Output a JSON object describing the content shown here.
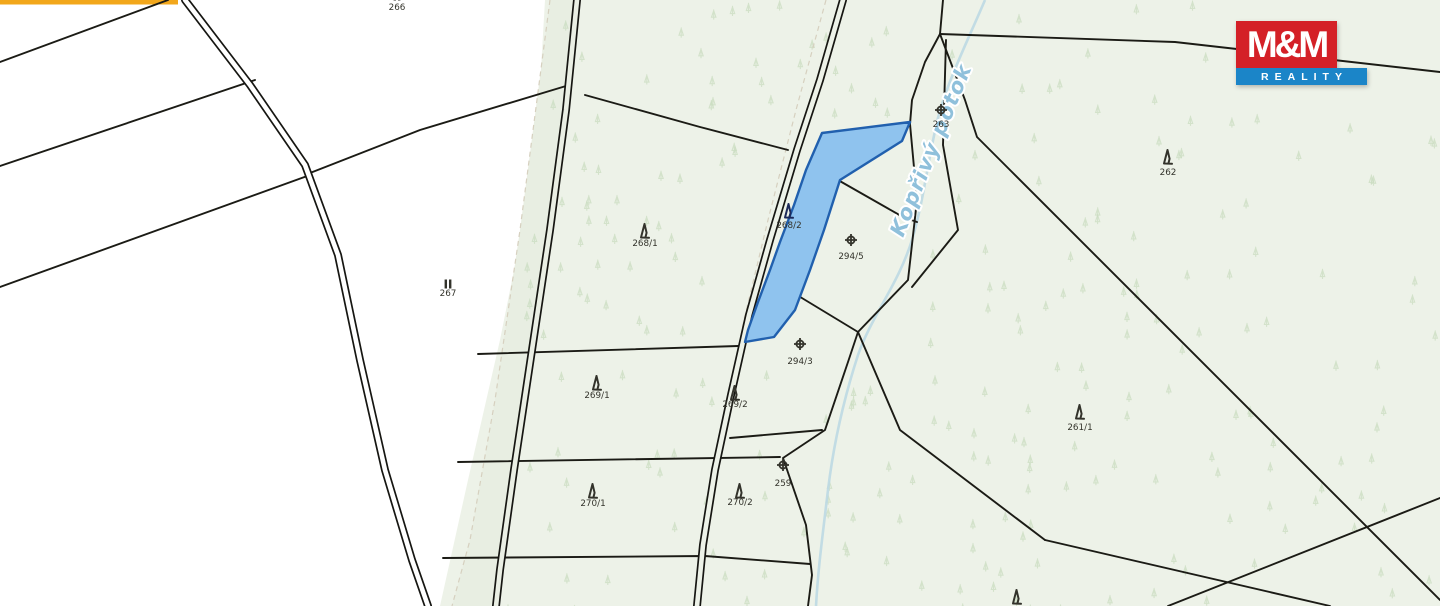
{
  "map": {
    "background_color": "#ffffff",
    "green_area_color": "#edf2e8",
    "strip_color": "#e8eee2",
    "boundary_color": "#1b1b15",
    "yellow_road_color": "#f2a71b",
    "scatter_tree_color": "#c9dcc0",
    "stream": {
      "color": "#bcd9e3"
    },
    "stream_label": {
      "text": "Kopřivý potok",
      "color": "#8fc0db"
    },
    "highlight_parcel": {
      "id": "268/2",
      "fill": "#8fc3ee",
      "stroke": "#2160ae",
      "label_color": "#1d2a5a"
    },
    "parcels": [
      {
        "id": "266",
        "x": 397,
        "y": 10,
        "symbol": "meadow",
        "sy": -4
      },
      {
        "id": "267",
        "x": 448,
        "y": 296,
        "symbol": "meadow",
        "sy": 284
      },
      {
        "id": "268/1",
        "x": 645,
        "y": 246,
        "symbol": "conifer",
        "sy": 224
      },
      {
        "id": "268/2",
        "x": 789,
        "y": 228,
        "symbol": "conifer",
        "sy": 204,
        "highlight": true
      },
      {
        "id": "269/1",
        "x": 597,
        "y": 398,
        "symbol": "conifer",
        "sy": 376
      },
      {
        "id": "269/2",
        "x": 735,
        "y": 407,
        "symbol": "conifer",
        "sy": 386
      },
      {
        "id": "270/1",
        "x": 593,
        "y": 506,
        "symbol": "conifer",
        "sy": 484
      },
      {
        "id": "270/2",
        "x": 740,
        "y": 505,
        "symbol": "conifer",
        "sy": 484
      },
      {
        "id": "259",
        "x": 783,
        "y": 486,
        "symbol": "orchard",
        "sy": 465
      },
      {
        "id": "294/5",
        "x": 851,
        "y": 259,
        "symbol": "orchard",
        "sy": 240
      },
      {
        "id": "294/3",
        "x": 800,
        "y": 364,
        "symbol": "orchard",
        "sy": 344
      },
      {
        "id": "263",
        "x": 941,
        "y": 127,
        "symbol": "orchard",
        "sy": 110
      },
      {
        "id": "262",
        "x": 1168,
        "y": 175,
        "symbol": "conifer",
        "sy": 150
      },
      {
        "id": "261/1",
        "x": 1080,
        "y": 430,
        "symbol": "conifer",
        "sy": 405
      },
      {
        "id": "",
        "x": 1017,
        "y": 622,
        "symbol": "conifer",
        "sy": 590
      }
    ]
  },
  "logo": {
    "line1": "M&M",
    "line2": "REALITY",
    "red": "#d42027",
    "blue": "#1b85c8"
  }
}
